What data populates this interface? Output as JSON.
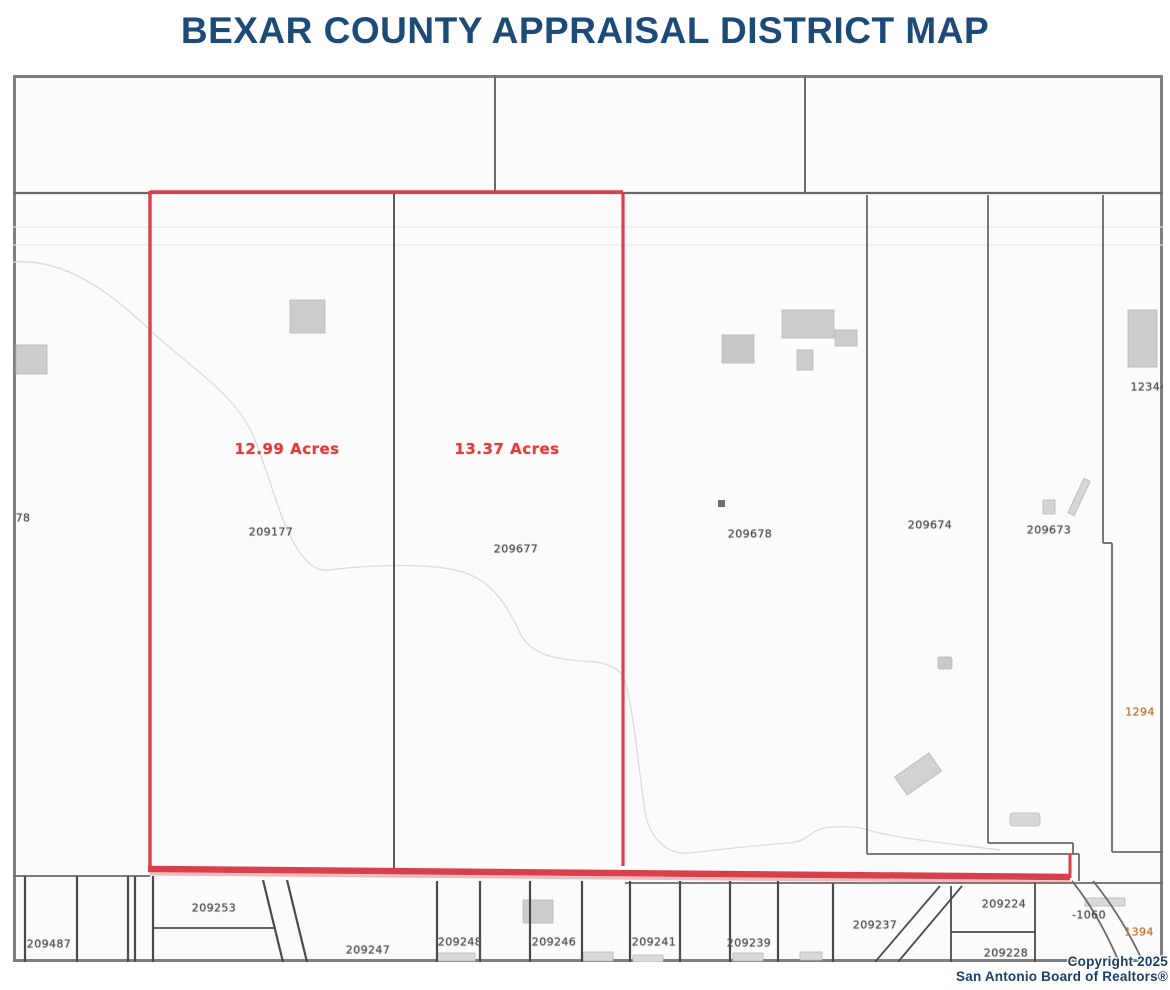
{
  "page": {
    "title": "BEXAR COUNTY APPRAISAL DISTRICT MAP"
  },
  "map_data": {
    "type": "appraisal-parcel-map",
    "county": "Bexar County",
    "colors": {
      "highlight_red": "#d8414b",
      "acre_text_red": "#e23b3b",
      "title_navy": "#1d4b78",
      "label_gray": "#4f4f4f",
      "road_label_orange": "#bf7230",
      "parcel_line_gray": "#6a6a6a"
    },
    "highlighted_parcels": [
      {
        "parcel_id": "209177",
        "acreage_label": "12.99 Acres"
      },
      {
        "parcel_id": "209677",
        "acreage_label": "13.37 Acres"
      }
    ],
    "acre_labels": [
      {
        "text": "12.99 Acres",
        "x": 274,
        "y": 374
      },
      {
        "text": "13.37 Acres",
        "x": 494,
        "y": 374
      }
    ],
    "parcel_labels": [
      {
        "text": "78",
        "x": 10,
        "y": 443
      },
      {
        "text": "209177",
        "x": 258,
        "y": 457
      },
      {
        "text": "209677",
        "x": 503,
        "y": 474
      },
      {
        "text": "209678",
        "x": 737,
        "y": 459
      },
      {
        "text": "209674",
        "x": 917,
        "y": 450
      },
      {
        "text": "209673",
        "x": 1036,
        "y": 455
      },
      {
        "text": "12344",
        "x": 1136,
        "y": 312
      },
      {
        "text": "1294",
        "x": 1127,
        "y": 637,
        "color": "orange"
      },
      {
        "text": "209487",
        "x": 36,
        "y": 869
      },
      {
        "text": "209253",
        "x": 201,
        "y": 833
      },
      {
        "text": "209247",
        "x": 355,
        "y": 875
      },
      {
        "text": "209248",
        "x": 447,
        "y": 867
      },
      {
        "text": "209246",
        "x": 541,
        "y": 867
      },
      {
        "text": "209241",
        "x": 641,
        "y": 867
      },
      {
        "text": "209239",
        "x": 736,
        "y": 868
      },
      {
        "text": "209237",
        "x": 862,
        "y": 850
      },
      {
        "text": "209224",
        "x": 991,
        "y": 829
      },
      {
        "text": "209228",
        "x": 993,
        "y": 878
      },
      {
        "text": "-1060",
        "x": 1076,
        "y": 840
      },
      {
        "text": "1394",
        "x": 1126,
        "y": 857,
        "color": "orange"
      }
    ],
    "copyright": {
      "line1": "Copyright 2025",
      "line2": "San Antonio Board of Realtors®"
    }
  }
}
